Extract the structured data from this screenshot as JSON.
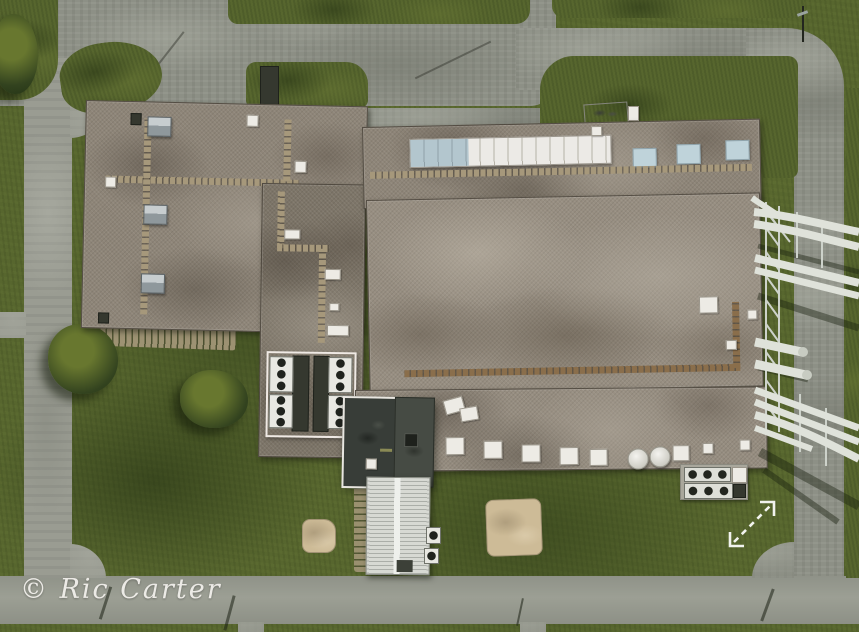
{
  "meta": {
    "type": "aerial-drone-photograph",
    "description": "Top-down aerial photo of an industrial facility: flat gravel roofs with paver walkways, skylights and HVAC fan units, a dark rooftop penthouse, a long white ridge skylight, a white elevated pipe rack crossing a road on the east side, asphalt service roads looping around mowed lawns, shrubs, sandy patches and a small white corrugated-metal outbuilding."
  },
  "watermark": {
    "text": "© Ric Carter"
  },
  "overlay": {
    "expand_icon": "expand-diagonal-arrow"
  },
  "palette": {
    "grass": "#57662e",
    "grass_dark": "#46552a",
    "grass_light": "#68772f",
    "bush_dark": "#33431f",
    "asphalt": "#8d9086",
    "asphalt_light": "#979a90",
    "concrete": "#9a9c92",
    "gravel": "#8e8578",
    "gravel_dark": "#7d7568",
    "gravel_light": "#a59c8f",
    "skylight_white": "#eceae6",
    "skylight_blue": "#bfd3da",
    "penthouse_dark": "#383d38",
    "metal_roof_white": "#d7d9d3",
    "pipe_white": "#dfe2da",
    "sand": "#cdbb97",
    "paver_tan": "#a6987b",
    "watermark_color": "#f4f2ee",
    "arrow_color": "#f2f3ee"
  },
  "scene": {
    "features": [
      "west flat gravel roof with tan paver walkways and pyramid skylights",
      "center roof section with four fan ventilation units in a white-curbed enclosure",
      "dark rooftop penthouse structure",
      "east building top strip with long segmented white ridge skylight and three blue skylights",
      "east main gravel roof with brown paver walkway and roof hatches",
      "east lower roof strip with skylight boxes and round white tanks",
      "white corrugated metal outbuilding",
      "ground HVAC condenser pad",
      "white elevated pipe rack crossing the east service road",
      "asphalt service roads with grass islands",
      "trees, shrubs, sandy patches, street-light shadows on south road"
    ]
  }
}
